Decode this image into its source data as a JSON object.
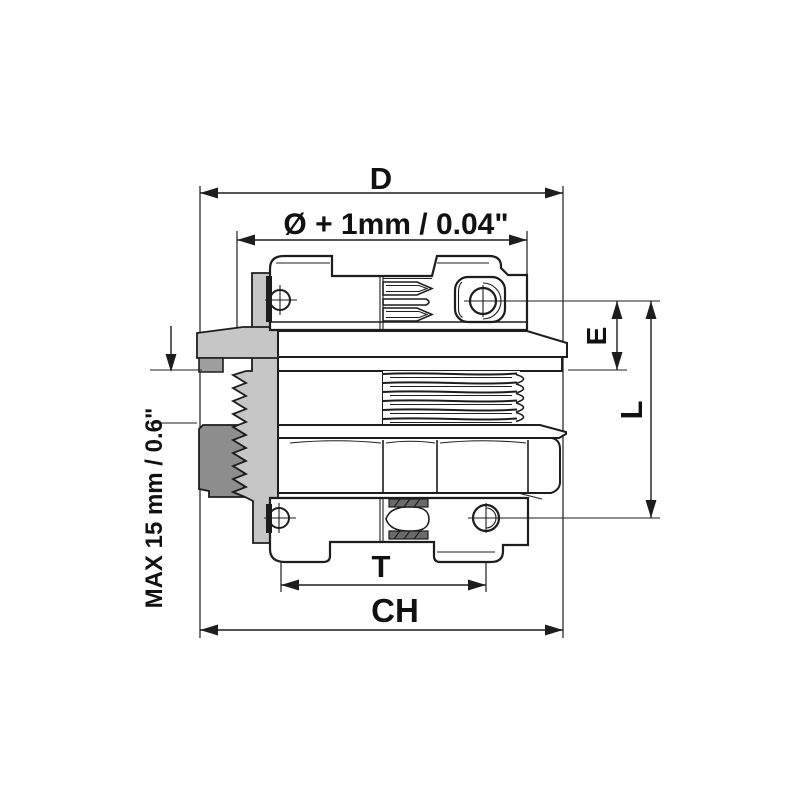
{
  "figure": {
    "type": "technical-drawing",
    "subject": "cable gland cross-section with dimension callouts"
  },
  "dimension_labels": {
    "overall_width": "D",
    "clearance_diameter": "Ø + 1mm / 0.04\"",
    "upper_height": "E",
    "total_height": "L",
    "locknut_span": "T",
    "hex_width": "CH",
    "max_panel_thickness": "MAX 15 mm / 0.6\""
  },
  "colors": {
    "line": "#1d1d1d",
    "seal_light": "#c6c6c6",
    "seal_medium": "#9e9e9e",
    "seal_dark": "#8d8d8d",
    "hatch_dark": "#6a6a6a",
    "background": "#ffffff"
  }
}
